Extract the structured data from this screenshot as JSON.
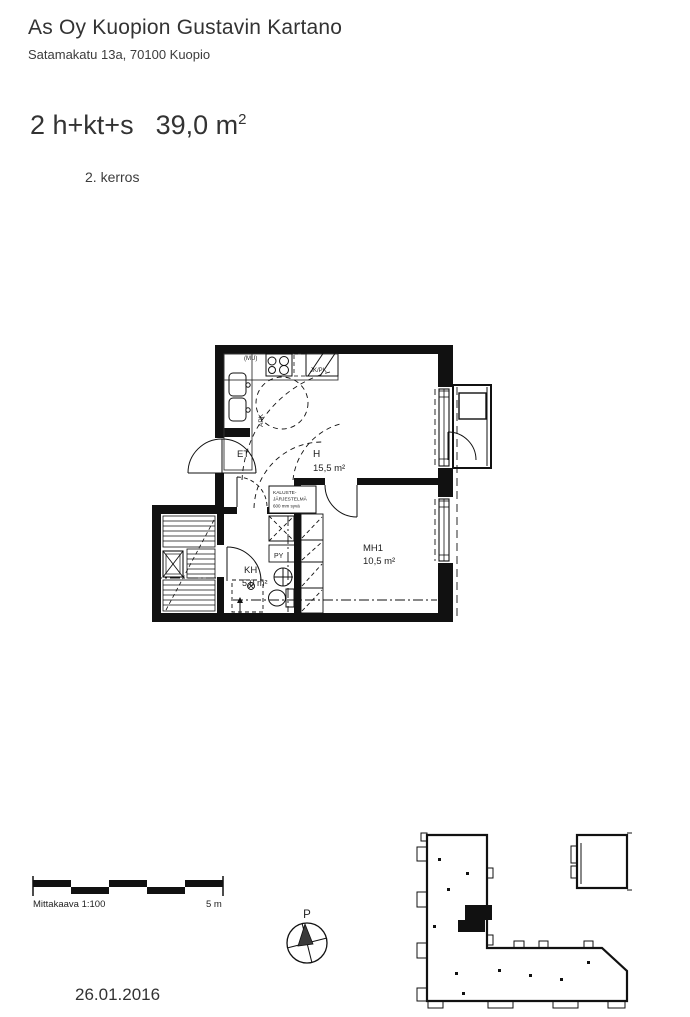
{
  "header": {
    "title": "As Oy Kuopion Gustavin Kartano",
    "address": "Satamakatu 13a, 70100 Kuopio",
    "apartment_type": "2 h+kt+s",
    "area_value": "39,0 m",
    "area_sup": "2",
    "floor": "2. kerros"
  },
  "floor_plan": {
    "rooms": [
      {
        "label": "H",
        "area": "15,5 m²"
      },
      {
        "label": "MH1",
        "area": "10,5 m²"
      },
      {
        "label": "KH",
        "area": "5,0 m²"
      },
      {
        "label": "ET",
        "area": ""
      }
    ],
    "fixtures": {
      "mu": "(MU)",
      "jk_pk": "JK/PK",
      "apk": "APK",
      "py": "PY"
    },
    "annotation": {
      "line1": "KALUSTE-",
      "line2": "JÄRJESTELMÄ",
      "line3": "600 mm syvä"
    }
  },
  "scale_bar": {
    "label": "Mittakaava 1:100",
    "length_label": "5 m"
  },
  "compass": {
    "north_label": "P"
  },
  "footer": {
    "date": "26.01.2016"
  },
  "colors": {
    "ink": "#111111",
    "text": "#2e2e2e"
  }
}
